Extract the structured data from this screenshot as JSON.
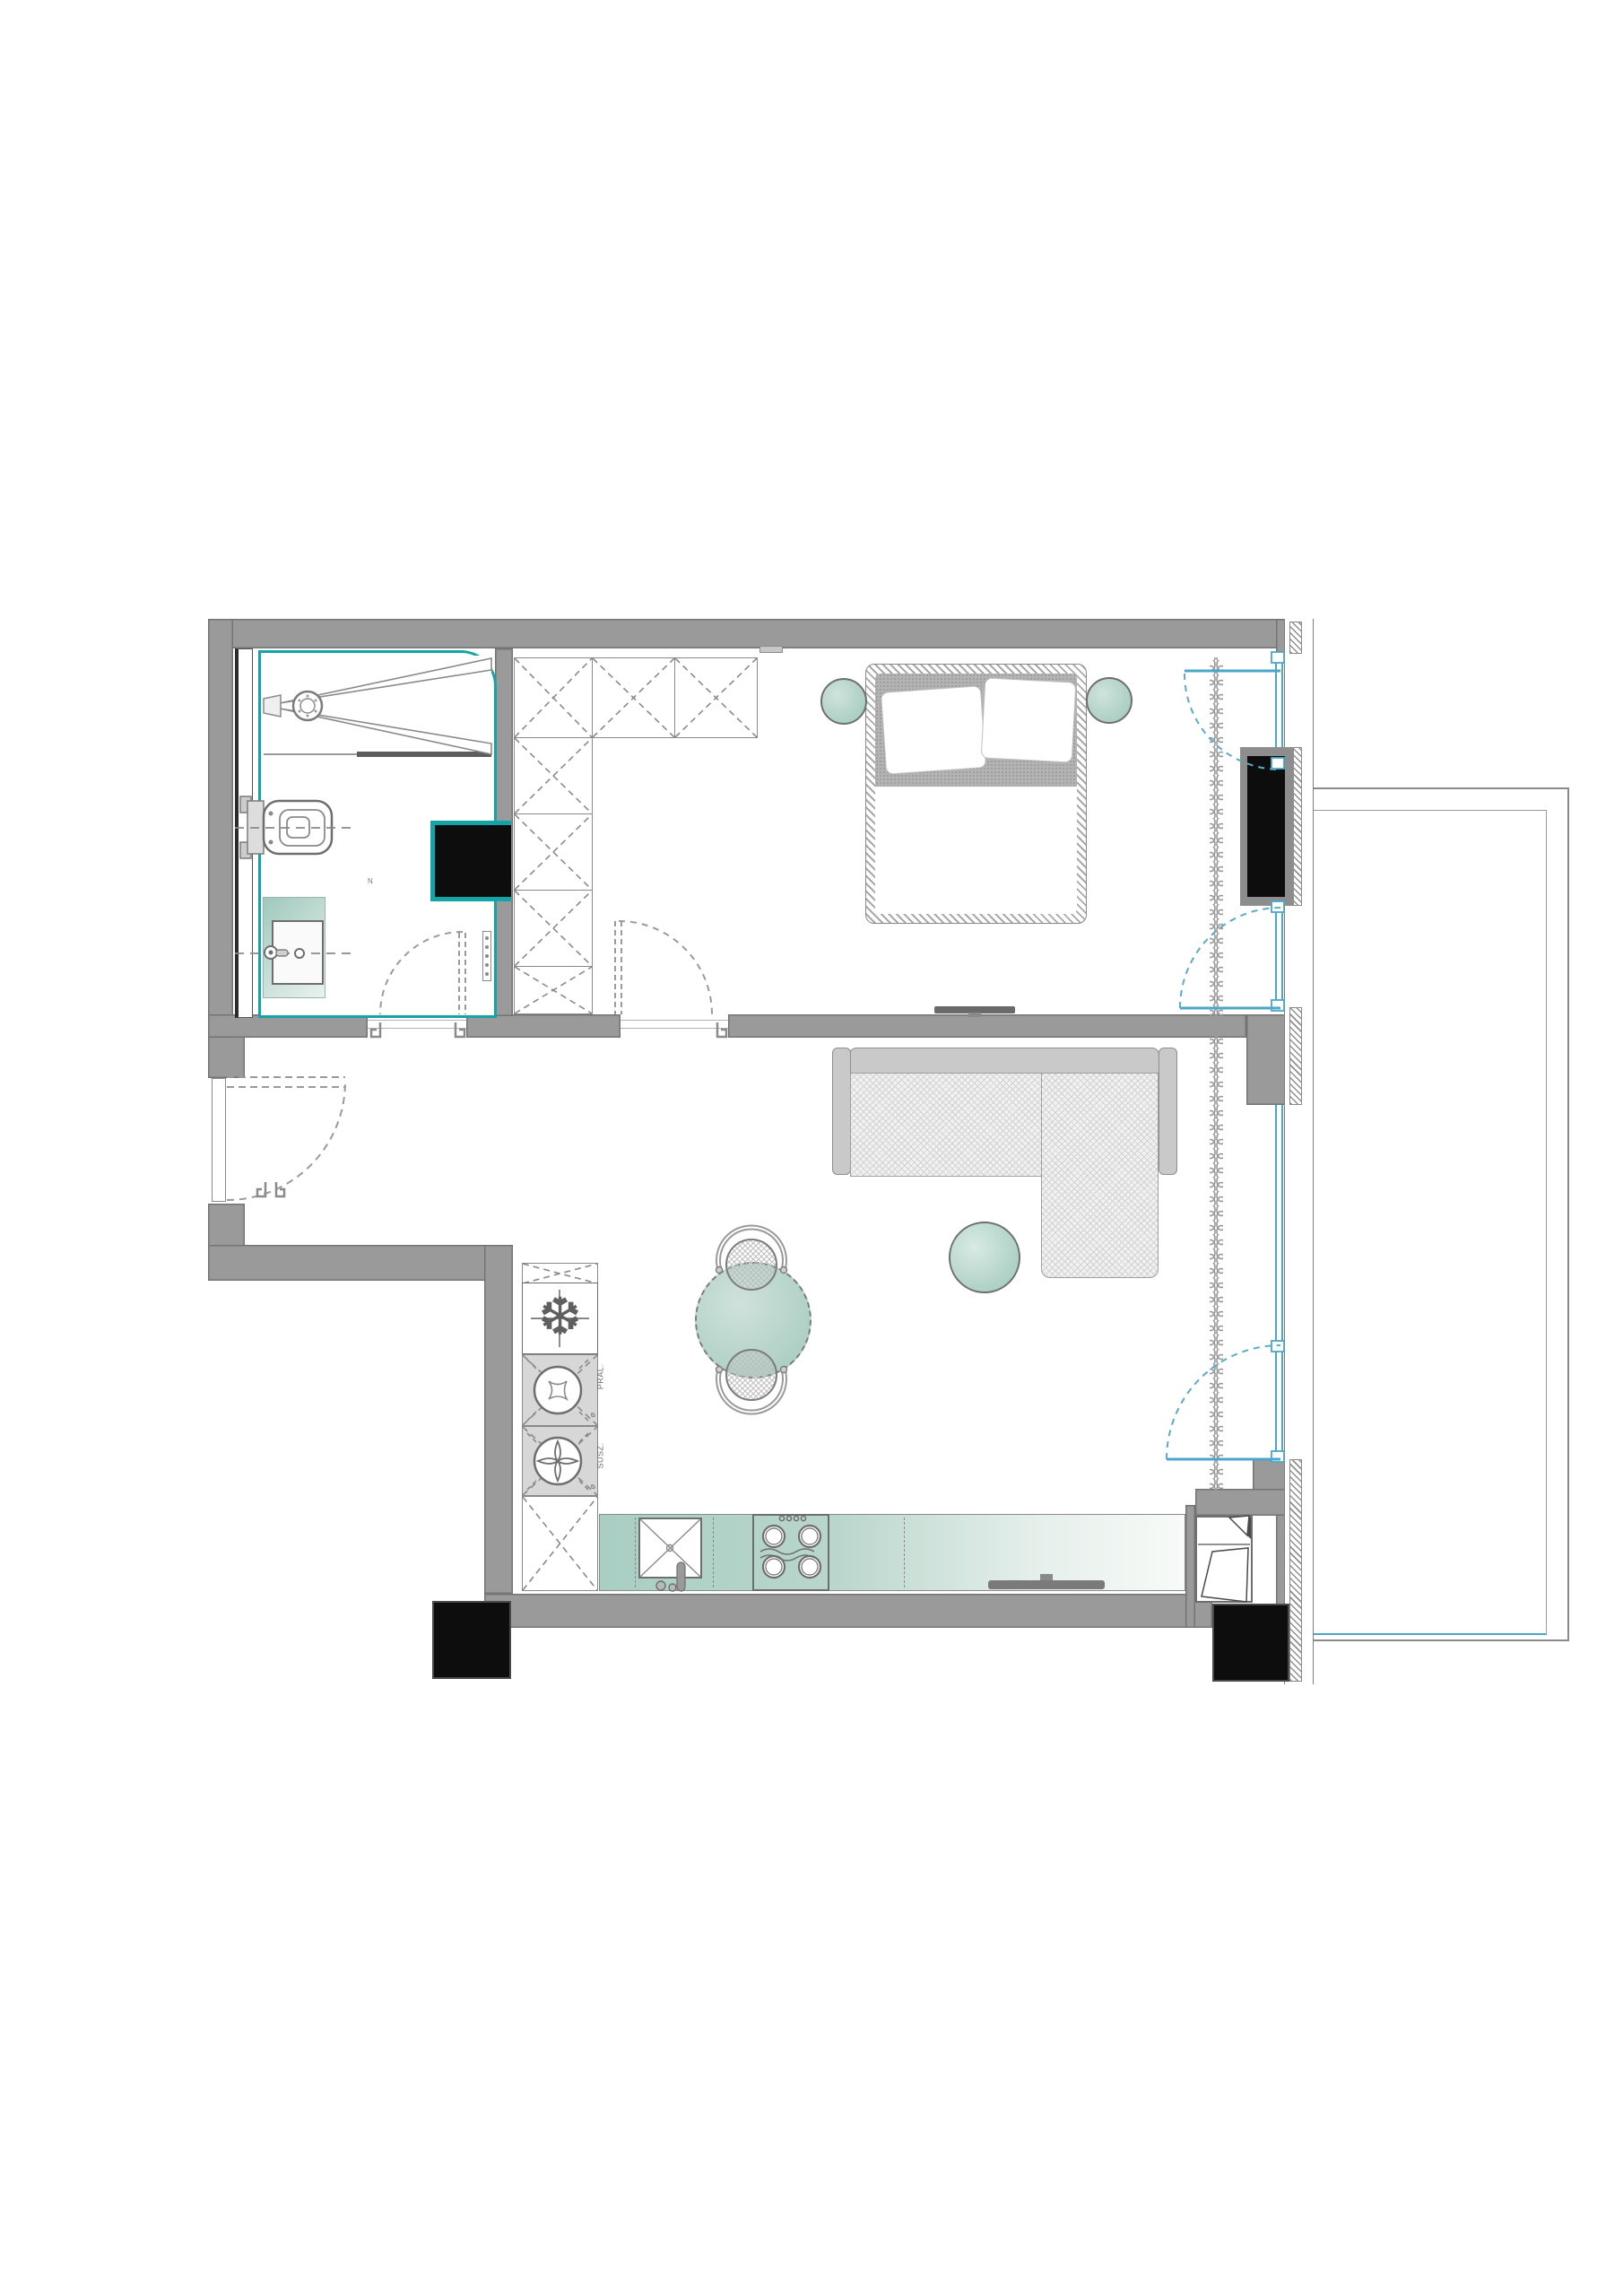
{
  "document": {
    "type": "architectural-floor-plan",
    "background": "#ffffff"
  },
  "palette": {
    "wall_gray": "#9a9a9a",
    "wall_edge": "#747474",
    "accent_teal": "#14a3a6",
    "window_blue": "#4ba7c9",
    "furniture_teal_dark": "#9fc8bc",
    "furniture_teal_light": "#e9f2ee",
    "structure_black": "#0d0d0d",
    "line_gray": "#8a8a8a"
  },
  "texts": {
    "washer_label": "PRAL.",
    "washer_diameter_mark": "⌀",
    "dryer_label": "SUSZ.",
    "dryer_diameter_mark": "⌀",
    "north_mark": "N"
  },
  "icons": {
    "fridge_icon": "❆",
    "shower_drain_icon": "round-drain",
    "hob_icon": "four-burners",
    "washer_icon": "drum-circle",
    "dryer_icon": "fan-circle"
  },
  "elements": [
    "bathroom-with-shower-toilet-sink",
    "hallway-with-entrance-door",
    "wardrobe-l-shaped-x-boxes",
    "bedroom-double-bed-two-side-tables",
    "bedroom-tv",
    "glazed-facade-with-balcony-doors",
    "curtain-line",
    "balcony-slab",
    "living-room-corner-sofa",
    "round-coffee-table",
    "round-dining-table-two-chairs",
    "kitchen-appliance-column-fridge-washer-dryer",
    "kitchen-counter-sink-hob",
    "sideboard-tv",
    "structural-columns"
  ]
}
